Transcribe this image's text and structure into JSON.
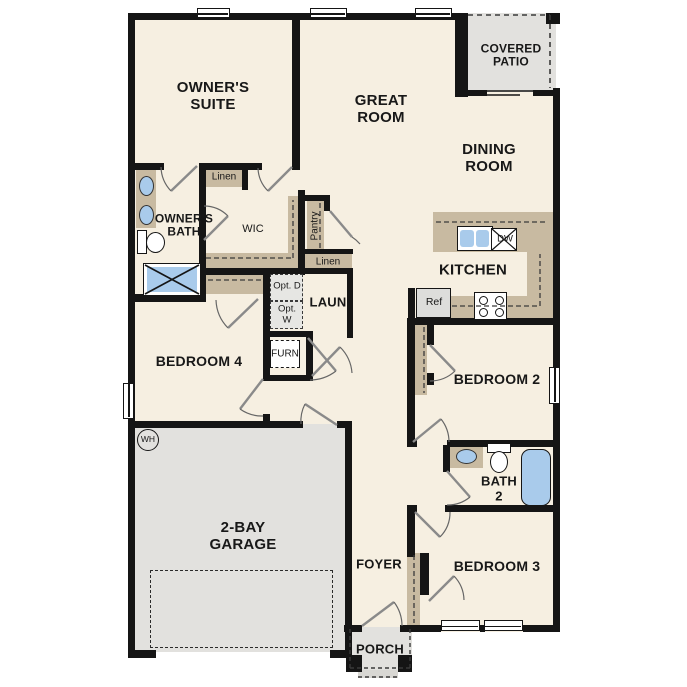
{
  "rooms": {
    "owners_suite": "OWNER'S SUITE",
    "great_room": "GREAT ROOM",
    "covered_patio": "COVERED PATIO",
    "dining_room": "DINING ROOM",
    "owners_bath": "OWNER'S BATH",
    "wic": "WIC",
    "laundry": "LAUN",
    "kitchen": "KITCHEN",
    "bedroom4": "BEDROOM 4",
    "bedroom2": "BEDROOM 2",
    "bath2": "BATH 2",
    "garage": "2-BAY GARAGE",
    "foyer": "FOYER",
    "bedroom3": "BEDROOM 3",
    "porch": "PORCH"
  },
  "closets": {
    "linen1": "Linen",
    "pantry": "Pantry",
    "linen2": "Linen"
  },
  "equipment": {
    "opt_dryer": "Opt. D",
    "opt_washer": "Opt. W",
    "furnace": "FURN",
    "refrigerator": "Ref",
    "dishwasher": "DW",
    "water_heater": "WH"
  },
  "colors": {
    "floor": "#F6EFE1",
    "casework_tan": "#C8BAA1",
    "concrete_gray": "#E2E1DE",
    "fixture_blue": "#A9CBEB",
    "wall_black": "#151515"
  }
}
